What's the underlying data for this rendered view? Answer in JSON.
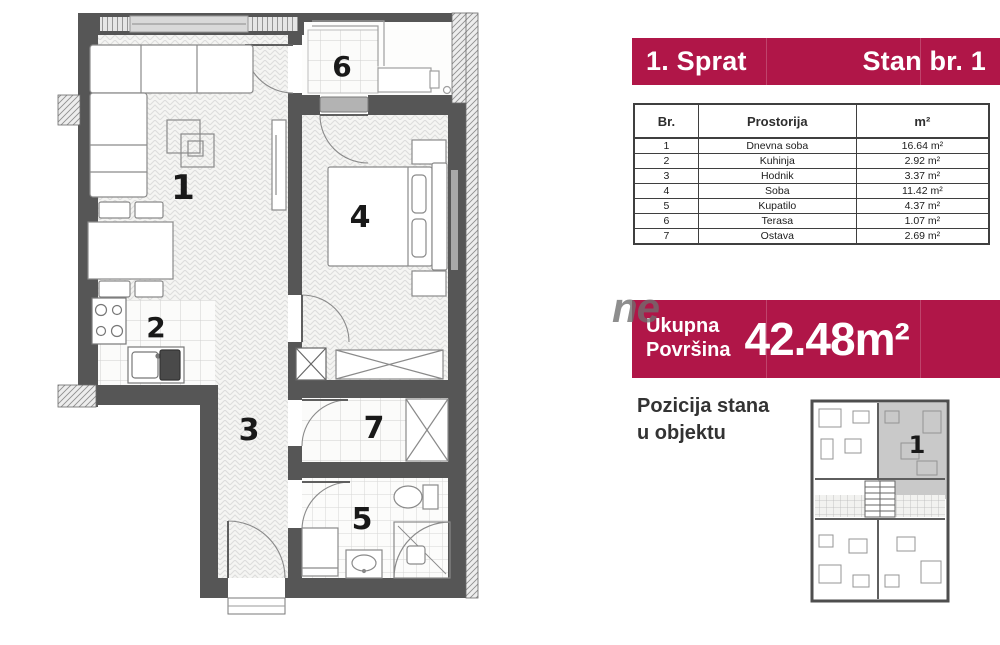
{
  "panel": {
    "header": {
      "floor": "1. Sprat",
      "unit": "Stan br. 1"
    },
    "table": {
      "columns": [
        "Br.",
        "Prostorija",
        "m²"
      ],
      "rows": [
        {
          "br": "1",
          "name": "Dnevna soba",
          "area": "16.64 m²"
        },
        {
          "br": "2",
          "name": "Kuhinja",
          "area": "2.92 m²"
        },
        {
          "br": "3",
          "name": "Hodnik",
          "area": "3.37 m²"
        },
        {
          "br": "4",
          "name": "Soba",
          "area": "11.42 m²"
        },
        {
          "br": "5",
          "name": "Kupatilo",
          "area": "4.37 m²"
        },
        {
          "br": "6",
          "name": "Terasa",
          "area": "1.07 m²"
        },
        {
          "br": "7",
          "name": "Ostava",
          "area": "2.69 m²"
        }
      ]
    },
    "total": {
      "label_line1": "Ukupna",
      "label_line2": "Površina",
      "value": "42.48m²"
    },
    "position": {
      "line1": "Pozicija stana",
      "line2": "u objektu"
    }
  },
  "floor_plan": {
    "labels": {
      "living": "1",
      "kitchen": "2",
      "hall": "3",
      "bedroom": "4",
      "bath": "5",
      "terrace": "6",
      "storage": "7"
    }
  },
  "mini_plan": {
    "unit": "1"
  },
  "watermark": "ne",
  "colors": {
    "accent": "#b01648",
    "wall": "#565656"
  }
}
